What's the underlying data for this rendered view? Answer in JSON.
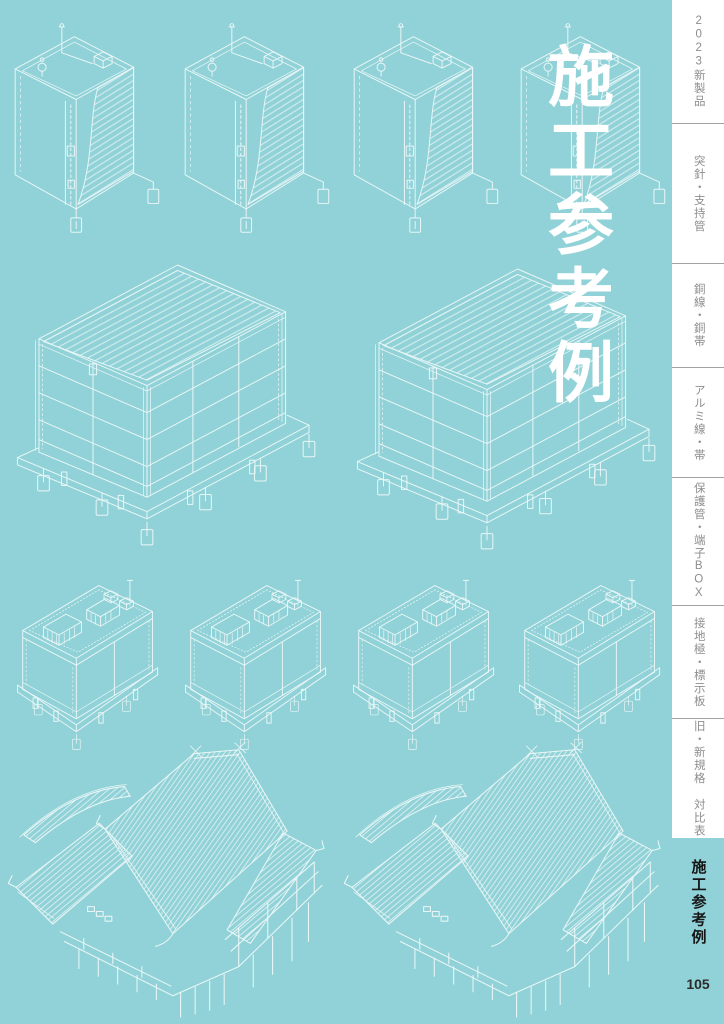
{
  "title": "施工参考例",
  "page_number": "105",
  "colors": {
    "background": "#90d2d7",
    "line_art": "#e9f6f7",
    "title_text": "#ffffff",
    "tab_text": "#8d8d8d",
    "active_tab_text": "#171717",
    "rail_background": "#ffffff",
    "divider": "#a2a2a2"
  },
  "sidebar": {
    "tabs": [
      {
        "label": "2023新製品"
      },
      {
        "label": "突針・支持管"
      },
      {
        "label": "銅線・銅帯"
      },
      {
        "label": "アルミ線・帯"
      },
      {
        "label": "保護管・端子BOX"
      },
      {
        "label": "接地極・標示板"
      },
      {
        "label": "旧・新規格 対比表"
      }
    ],
    "active_tab": "施工参考例"
  },
  "illustrations": {
    "row1": {
      "icon": "high-rise-building-with-lightning-rod-icon",
      "count": 4
    },
    "row2": {
      "icon": "warehouse-with-grounding-tags-icon",
      "count": 2
    },
    "row3": {
      "icon": "plant-building-with-rooftop-equipment-icon",
      "count": 4
    },
    "row4": {
      "icon": "traditional-temple-building-icon",
      "count": 2
    }
  }
}
